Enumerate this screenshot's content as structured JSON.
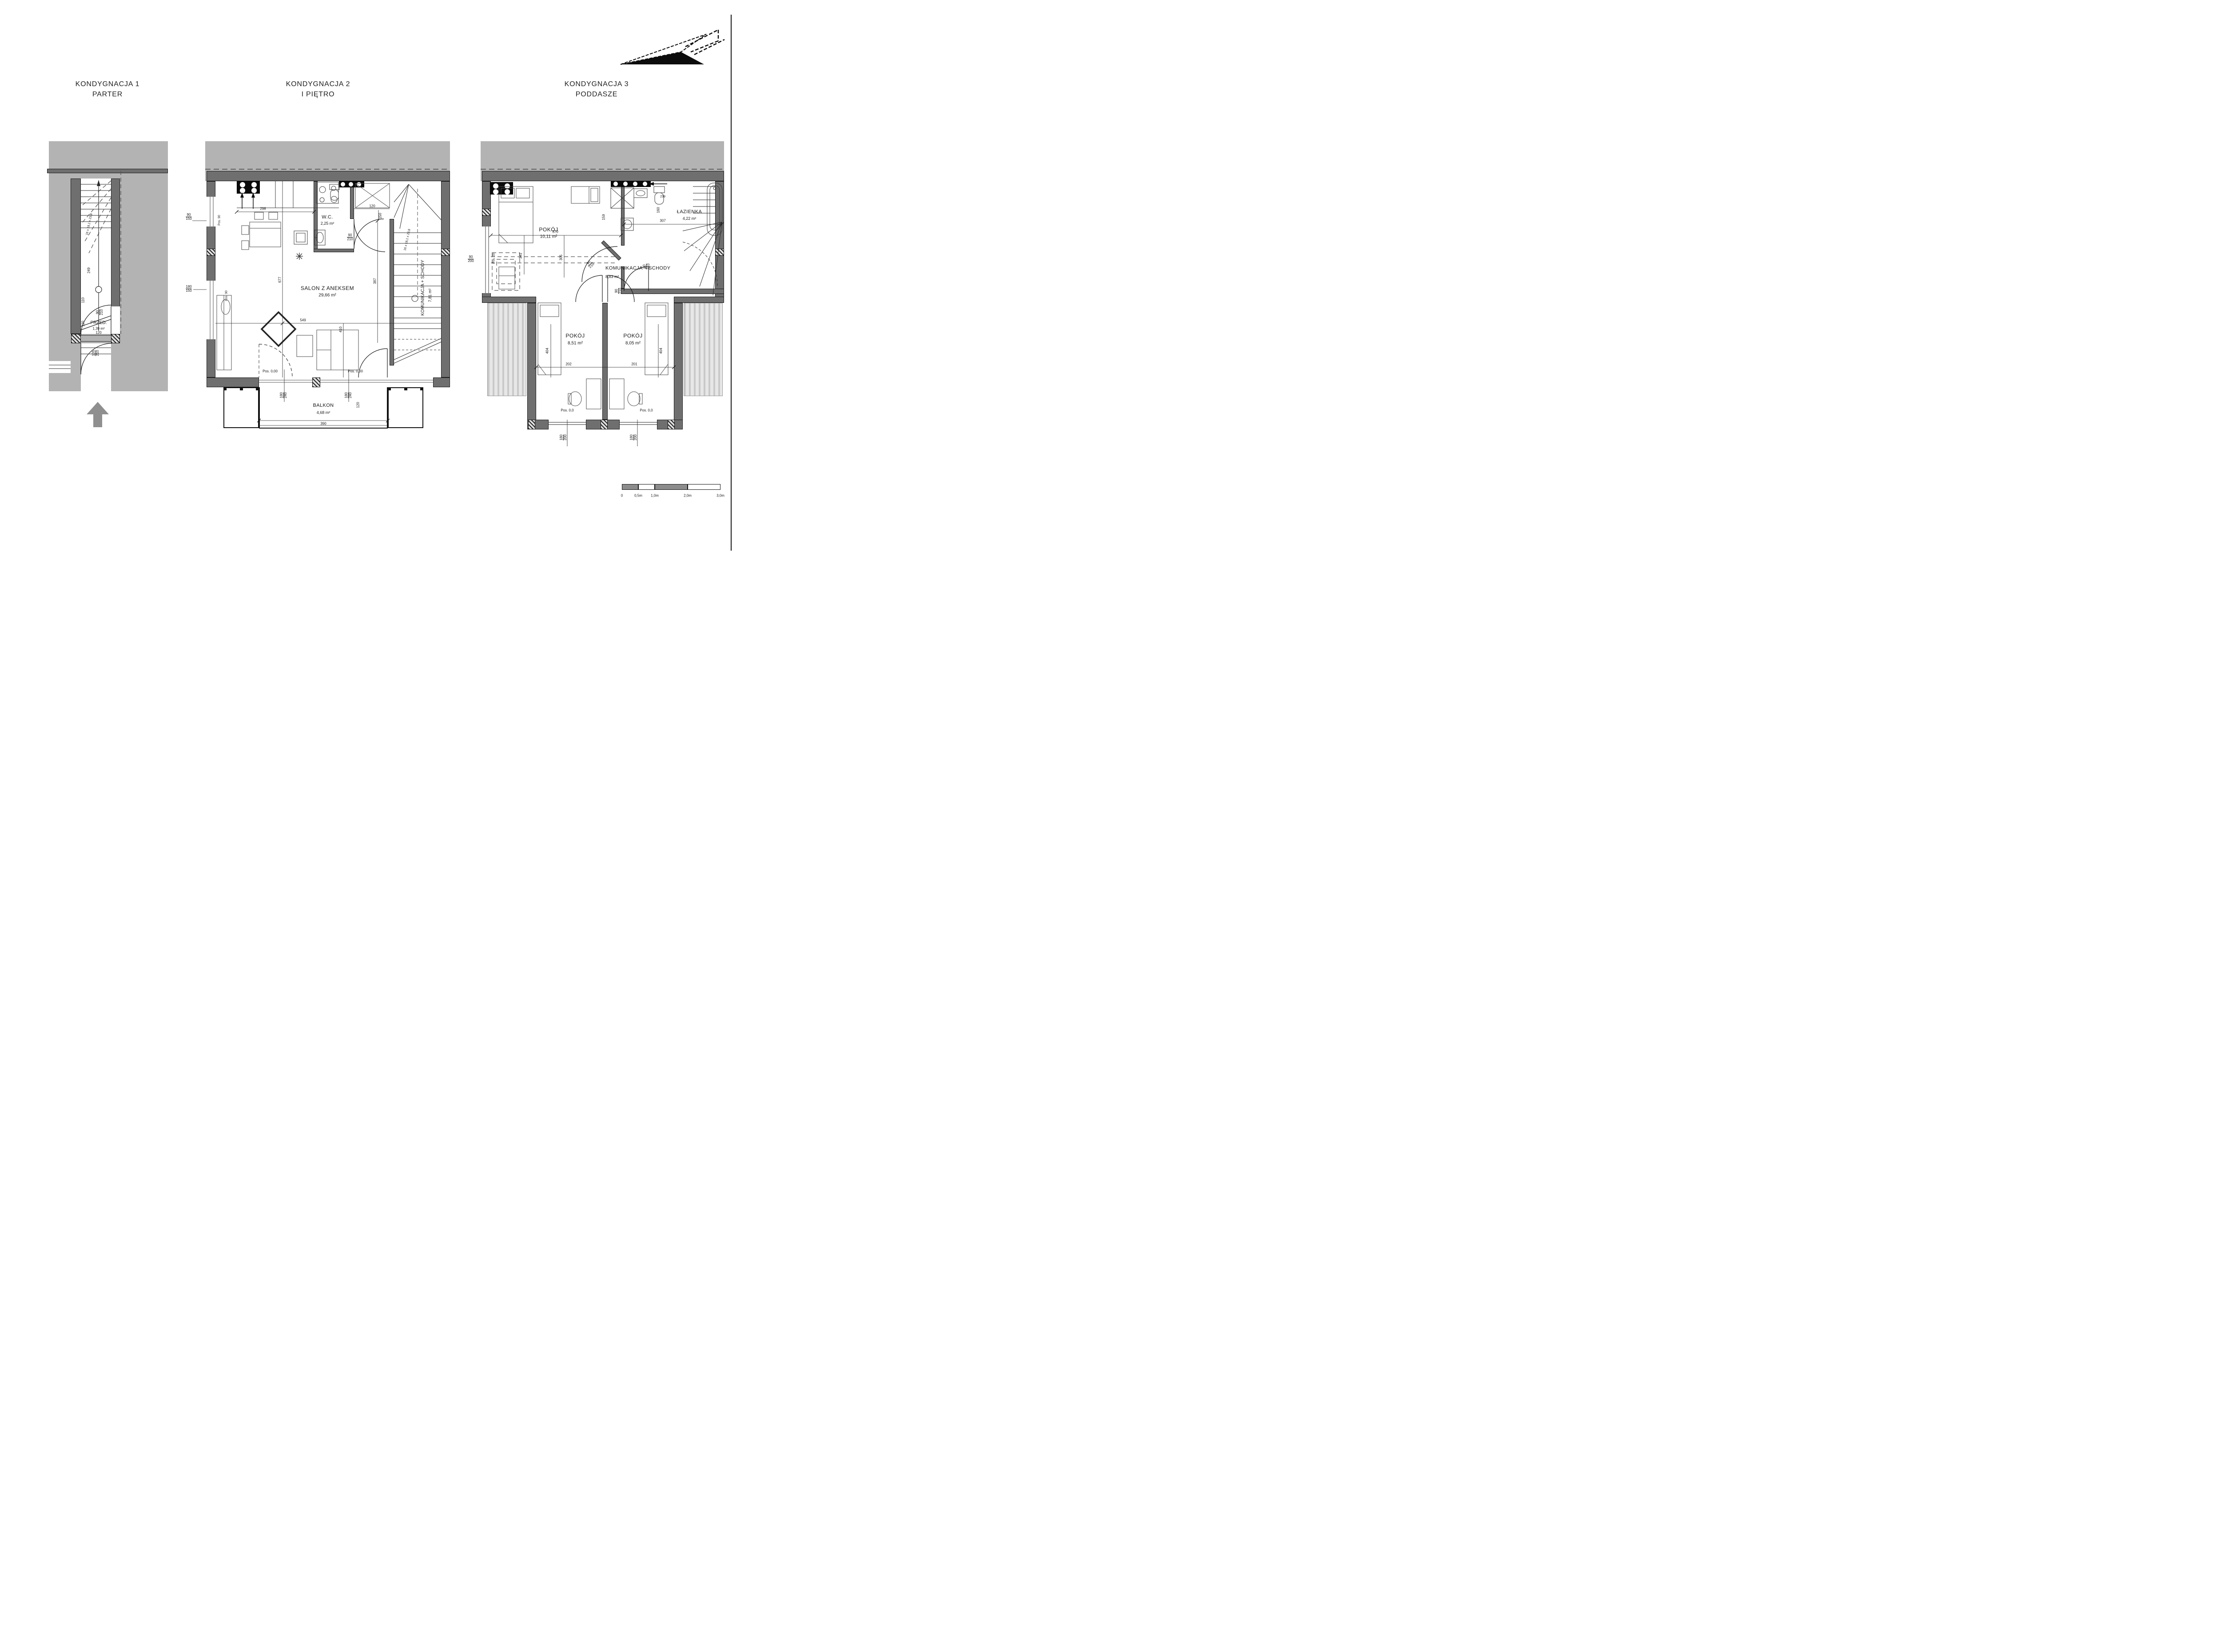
{
  "titles": [
    {
      "line1": "KONDYGNACJA 1",
      "line2": "PARTER"
    },
    {
      "line1": "KONDYGNACJA 2",
      "line2": "I PIĘTRO"
    },
    {
      "line1": "KONDYGNACJA 3",
      "line2": "PODDASZE"
    }
  ],
  "floor1": {
    "room": {
      "name": "PRZED.",
      "area": "1,39 m²"
    },
    "stair_formula": "16 x 18,1 x 23,8",
    "dims": {
      "d249": "249",
      "d110": "110",
      "d120v": "120",
      "d120h": "120",
      "door": {
        "top": "90",
        "bot": "210"
      },
      "entry": {
        "top": "105",
        "bot": "210"
      }
    }
  },
  "floor2": {
    "rooms": {
      "salon": {
        "name": "SALON Z ANEKSEM",
        "area": "29,66 m²"
      },
      "wc": {
        "name": "W.C.",
        "area": "2,25 m²"
      },
      "stairs": {
        "name": "KOMUNIKACJA + SCHODY",
        "area": "7,81 m²"
      },
      "balcony": {
        "name": "BALKON",
        "area": "4,68 m²"
      }
    },
    "stair_formula": "16 x 18,1 x 23,8",
    "dims": {
      "d298": "298",
      "d549": "549",
      "d677": "677",
      "d410": "410",
      "d387": "387",
      "d120": "120",
      "d150": "150",
      "d390": "390",
      "d120b": "120",
      "win1": {
        "top": "90",
        "bot": "150"
      },
      "win2": {
        "top": "180",
        "bot": "150"
      },
      "wcdoor": {
        "top": "90",
        "bot": "210"
      },
      "bdoor1": {
        "top": "180",
        "bot": "240"
      },
      "bdoor2": {
        "top": "180",
        "bot": "240"
      },
      "pos_win1": "Pos. 90",
      "pos_win2": "Pos. 90",
      "pos_a": "Pos. 0,00",
      "pos_b": "Pos. 0,00"
    }
  },
  "floor3": {
    "rooms": {
      "room1": {
        "name": "POKÓJ",
        "area": "10,11 m²"
      },
      "bath": {
        "name": "ŁAZIENKA",
        "area": "4,22 m²"
      },
      "stairs": {
        "name": "KOMUNIKACJA + SCHODY",
        "area": "8,83 m²"
      },
      "room2": {
        "name": "POKÓJ",
        "area": "8,51 m²"
      },
      "room3": {
        "name": "POKÓJ",
        "area": "8,05 m²"
      }
    },
    "dims": {
      "d370": "370",
      "d305": "305",
      "d341": "341",
      "d159": "159",
      "d239": "239",
      "d160": "160",
      "d307": "307",
      "d404a": "404",
      "d404b": "404",
      "d202": "202",
      "d201": "201",
      "win": {
        "top": "90",
        "bot": "200"
      },
      "door1": {
        "top": "90",
        "bot": "210"
      },
      "door2": {
        "top": "90",
        "bot": "210"
      },
      "door3": {
        "top": "90",
        "bot": "210"
      },
      "winA": {
        "top": "180",
        "bot": "200"
      },
      "winB": {
        "top": "180",
        "bot": "200"
      },
      "pos_win": "Pos. 20",
      "pos_a": "Pos. 0,0",
      "pos_b": "Pos. 0,0"
    }
  },
  "scalebar": {
    "labels": [
      "0",
      "0,5m",
      "1,0m",
      "2,0m",
      "3,0m"
    ]
  }
}
